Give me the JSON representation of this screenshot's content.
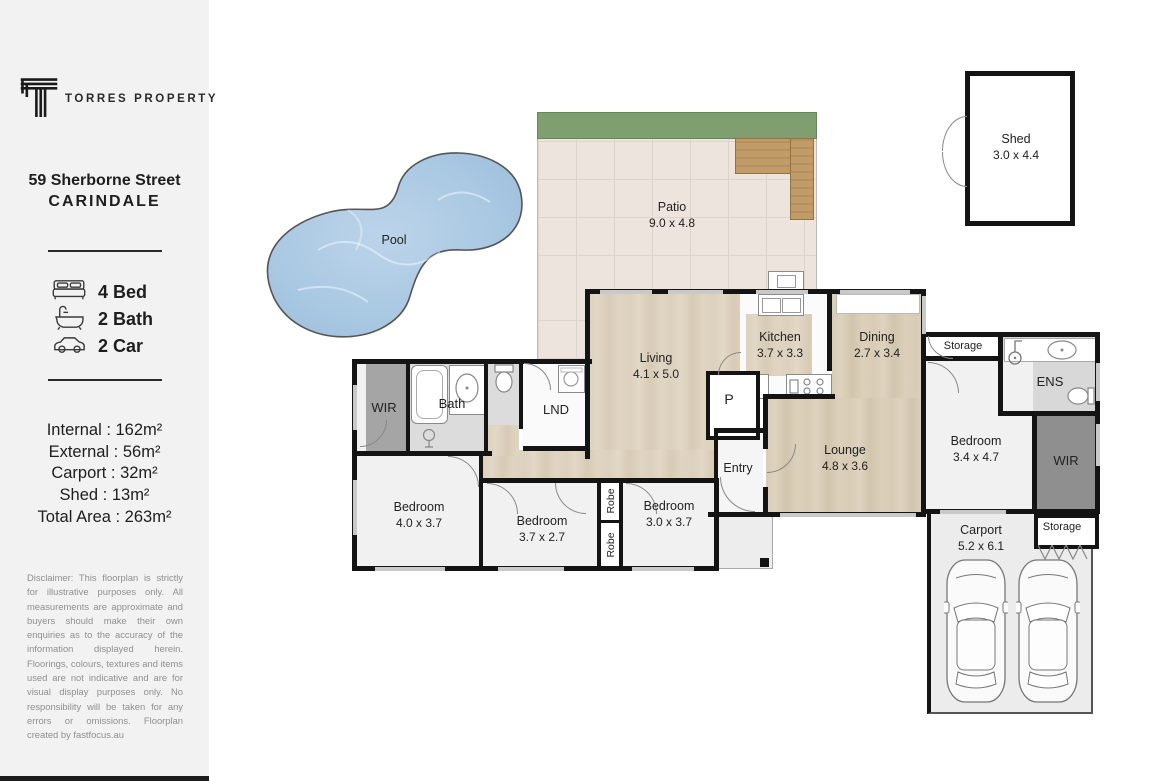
{
  "sidebar": {
    "brand": "TORRES PROPERTY",
    "address_line1": "59 Sherborne Street",
    "address_line2": "CARINDALE",
    "features": [
      {
        "icon": "bed-icon",
        "label": "4 Bed"
      },
      {
        "icon": "bath-icon",
        "label": "2 Bath"
      },
      {
        "icon": "car-icon",
        "label": "2 Car"
      }
    ],
    "areas": [
      "Internal : 162m²",
      "External : 56m²",
      "Carport : 32m²",
      "Shed : 13m²",
      "Total Area : 263m²"
    ],
    "disclaimer": "Disclaimer: This floorplan is strictly for illustrative purposes only. All measurements are approximate and buyers should make their own enquiries as to the accuracy of the information displayed herein. Floorings, colours, textures and items used are not indicative and are for visual display purposes only. No responsibility will be taken for any errors or omissions. Floorplan created by fastfocus.au"
  },
  "floorplan": {
    "rooms": {
      "pool": {
        "name": "Pool"
      },
      "patio": {
        "name": "Patio",
        "dims": "9.0 x 4.8"
      },
      "shed": {
        "name": "Shed",
        "dims": "3.0 x 4.4"
      },
      "living": {
        "name": "Living",
        "dims": "4.1 x 5.0"
      },
      "kitchen": {
        "name": "Kitchen",
        "dims": "3.7 x 3.3"
      },
      "dining": {
        "name": "Dining",
        "dims": "2.7 x 3.4"
      },
      "lounge": {
        "name": "Lounge",
        "dims": "4.8 x 3.6"
      },
      "entry": {
        "name": "Entry"
      },
      "pantry": {
        "name": "P"
      },
      "wir_left": {
        "name": "WIR"
      },
      "bath": {
        "name": "Bath"
      },
      "laundry": {
        "name": "LND"
      },
      "bedroom1": {
        "name": "Bedroom",
        "dims": "4.0 x 3.7"
      },
      "bedroom2": {
        "name": "Bedroom",
        "dims": "3.7 x 2.7"
      },
      "bedroom3": {
        "name": "Bedroom",
        "dims": "3.0 x 3.7"
      },
      "robe_upper": {
        "name": "Robe"
      },
      "robe_lower": {
        "name": "Robe"
      },
      "storage_top": {
        "name": "Storage"
      },
      "ens": {
        "name": "ENS"
      },
      "bedroom4": {
        "name": "Bedroom",
        "dims": "3.4 x 4.7"
      },
      "wir_right": {
        "name": "WIR"
      },
      "storage_right": {
        "name": "Storage"
      },
      "carport": {
        "name": "Carport",
        "dims": "5.2 x 6.1"
      }
    },
    "colors": {
      "wood_floor": "#ddd2bf",
      "patio_tile": "#ece4dd",
      "garden_green": "#7f9f70",
      "deck_wood": "#c09a66",
      "pool_water": "#abc8e2",
      "wall": "#141414",
      "bath_floor": "#dcdcdc",
      "wir_gray": "#9a9a9a",
      "carport_floor": "#ededed"
    }
  }
}
